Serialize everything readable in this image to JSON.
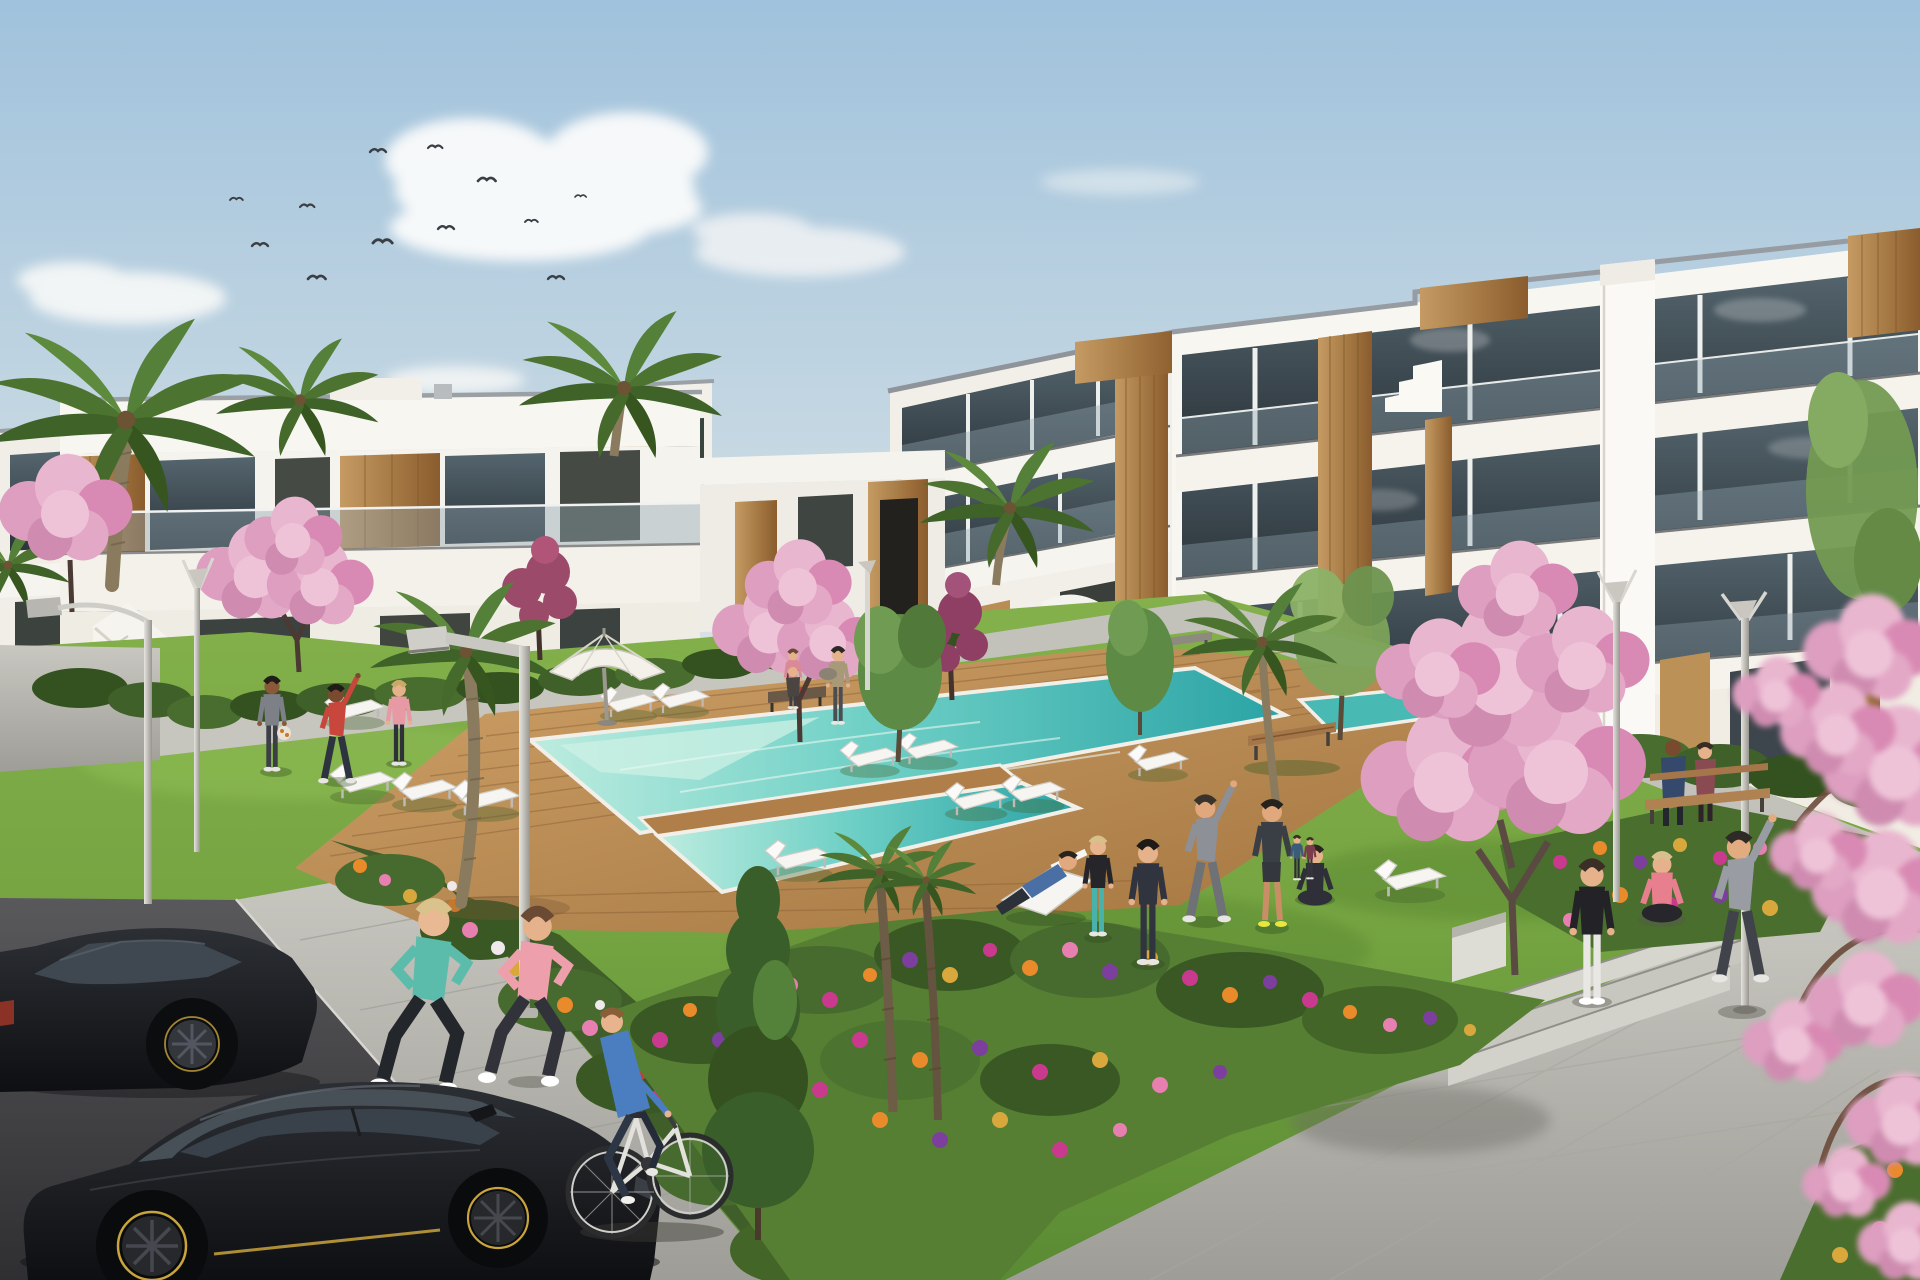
{
  "scene": {
    "type": "architectural-3d-render",
    "description": "Sunny 3D architectural rendering of a new-build white apartment complex with wooden facade accents, a communal turquoise swimming pool on a timber deck, lawns with people exercising, cherry-blossom trees, palm trees, flower beds, joggers, a cyclist and black cars in a parking area.",
    "aria_label": "Rendering of a residential complex with pool, gardens and people"
  },
  "palette": {
    "sky_top": "#a3c4dd",
    "sky_mid": "#c3d6e2",
    "sky_horizon": "#e2e6e4",
    "cloud": "#f8f9f9",
    "building_white": "#f7f5f0",
    "building_shade": "#e9e6df",
    "roof_cap": "#8b9196",
    "shadow_line": "#3a3e42",
    "glass_dark": "#45545d",
    "glass_deep": "#2a333a",
    "balustrade": "#8fa3ae",
    "wood_light": "#c59a63",
    "wood_dark": "#7d5627",
    "tan_wall": "#b98e55",
    "hedge": "#3f6129",
    "lawn_light": "#8ab84d",
    "lawn_dark": "#4f7c2a",
    "deck_light": "#c89a62",
    "deck_dark": "#8a5f33",
    "water_pale": "#b9ebdf",
    "water_mid": "#68cdc3",
    "water_deep": "#2ba5a6",
    "path": "#c2c1ba",
    "asphalt": "#4e4e52",
    "flower_magenta": "#c93a8e",
    "flower_pink": "#e77fb0",
    "flower_orange": "#e98a2b",
    "flower_gold": "#d9a83c",
    "flower_purple": "#7d3f9e",
    "blossom_pink": "#e9b6cf",
    "blossom_deep": "#c97fa8",
    "blossom_red": "#9c4a6a",
    "car_black": "#17181c",
    "car_accent_yellow": "#c9a43d",
    "lounger_white": "#f6f5f1"
  },
  "inventory": {
    "birds": 12,
    "clouds": 6,
    "buildings": [
      "left two-storey apartment row",
      "right three-storey apartment block"
    ],
    "pool": {
      "count": 1,
      "material": "timber deck surround",
      "color": "turquoise"
    },
    "sun_loungers": 11,
    "parasols": 1,
    "street_lamps": 5,
    "benches": 4,
    "cars": 2,
    "bicycles": 1,
    "palm_trees": 8,
    "blossom_trees": 8,
    "people": [
      {
        "label": "jogger",
        "top": "#5cbcab"
      },
      {
        "label": "jogger",
        "top": "#eda0ab"
      },
      {
        "label": "cyclist",
        "top": "#4a7ec0"
      },
      {
        "label": "man holding ball",
        "top": "#7d8187"
      },
      {
        "label": "man stretching",
        "top": "#c8463c"
      },
      {
        "label": "woman standing",
        "top": "#e89aa4"
      },
      {
        "label": "man reclining on deck chair",
        "top": "#4a6fa5"
      },
      {
        "label": "woman standing",
        "top": "#26262a",
        "leggings": "#49b2aa"
      },
      {
        "label": "person in hoodie",
        "top": "#30343f"
      },
      {
        "label": "man side-stretching",
        "top": "#8d9096"
      },
      {
        "label": "man in shorts",
        "top": "#3a3e45"
      },
      {
        "label": "woman seated cross-legged",
        "top": "#2e2f38"
      },
      {
        "label": "woman standing",
        "top": "#232327",
        "leggings": "#e9e7e3"
      },
      {
        "label": "woman seated on step",
        "top": "#e87f8e"
      },
      {
        "label": "person stretching arms up",
        "top": "#999ca3"
      },
      {
        "label": "couple on bench",
        "top": "#34496b"
      },
      {
        "label": "two walkers on path",
        "top": "#a89a78"
      }
    ]
  }
}
